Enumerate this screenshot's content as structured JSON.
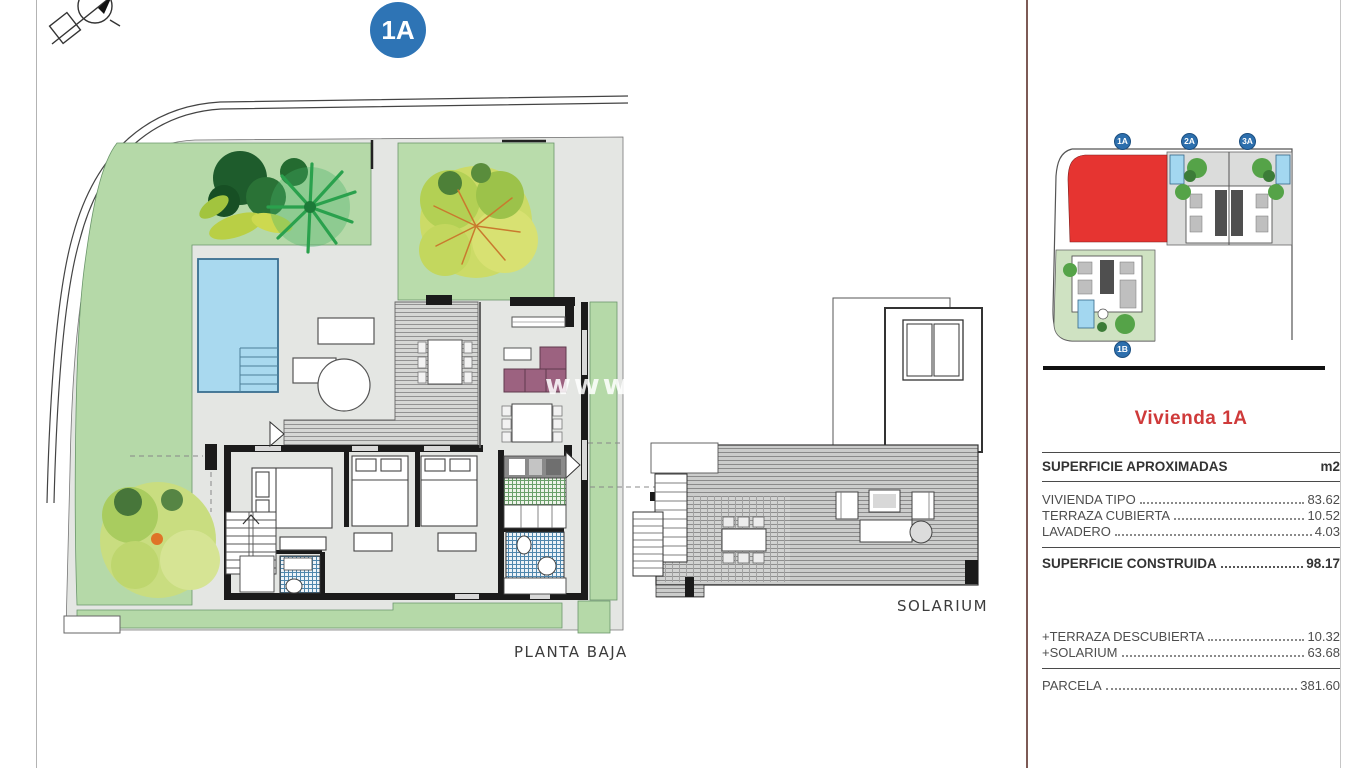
{
  "page": {
    "unit_badge": "1A",
    "planta_baja_label": "PLANTA BAJA",
    "solarium_label": "SOLARIUM",
    "watermark": "www"
  },
  "minimap": {
    "plots": [
      {
        "label": "1A",
        "highlighted": true
      },
      {
        "label": "2A",
        "highlighted": false
      },
      {
        "label": "3A",
        "highlighted": false
      },
      {
        "label": "1B",
        "highlighted": false
      }
    ],
    "highlight_color": "#e63431",
    "badge_color": "#2d6fad"
  },
  "panel": {
    "title": "Vivienda 1A",
    "title_color": "#cf3a3a",
    "table": {
      "header": {
        "label": "SUPERFICIE APROXIMADAS",
        "unit": "m2"
      },
      "rows": [
        {
          "label": "VIVIENDA TIPO",
          "value": "83.62"
        },
        {
          "label": "TERRAZA CUBIERTA",
          "value": "10.52"
        },
        {
          "label": "LAVADERO",
          "value": "4.03"
        }
      ],
      "total": {
        "label": "SUPERFICIE CONSTRUIDA",
        "value": "98.17"
      },
      "additions": [
        {
          "label": "+TERRAZA DESCUBIERTA",
          "value": "10.32"
        },
        {
          "label": "+SOLARIUM",
          "value": "63.68"
        }
      ],
      "parcel": {
        "label": "PARCELA",
        "value": "381.60"
      }
    }
  }
}
